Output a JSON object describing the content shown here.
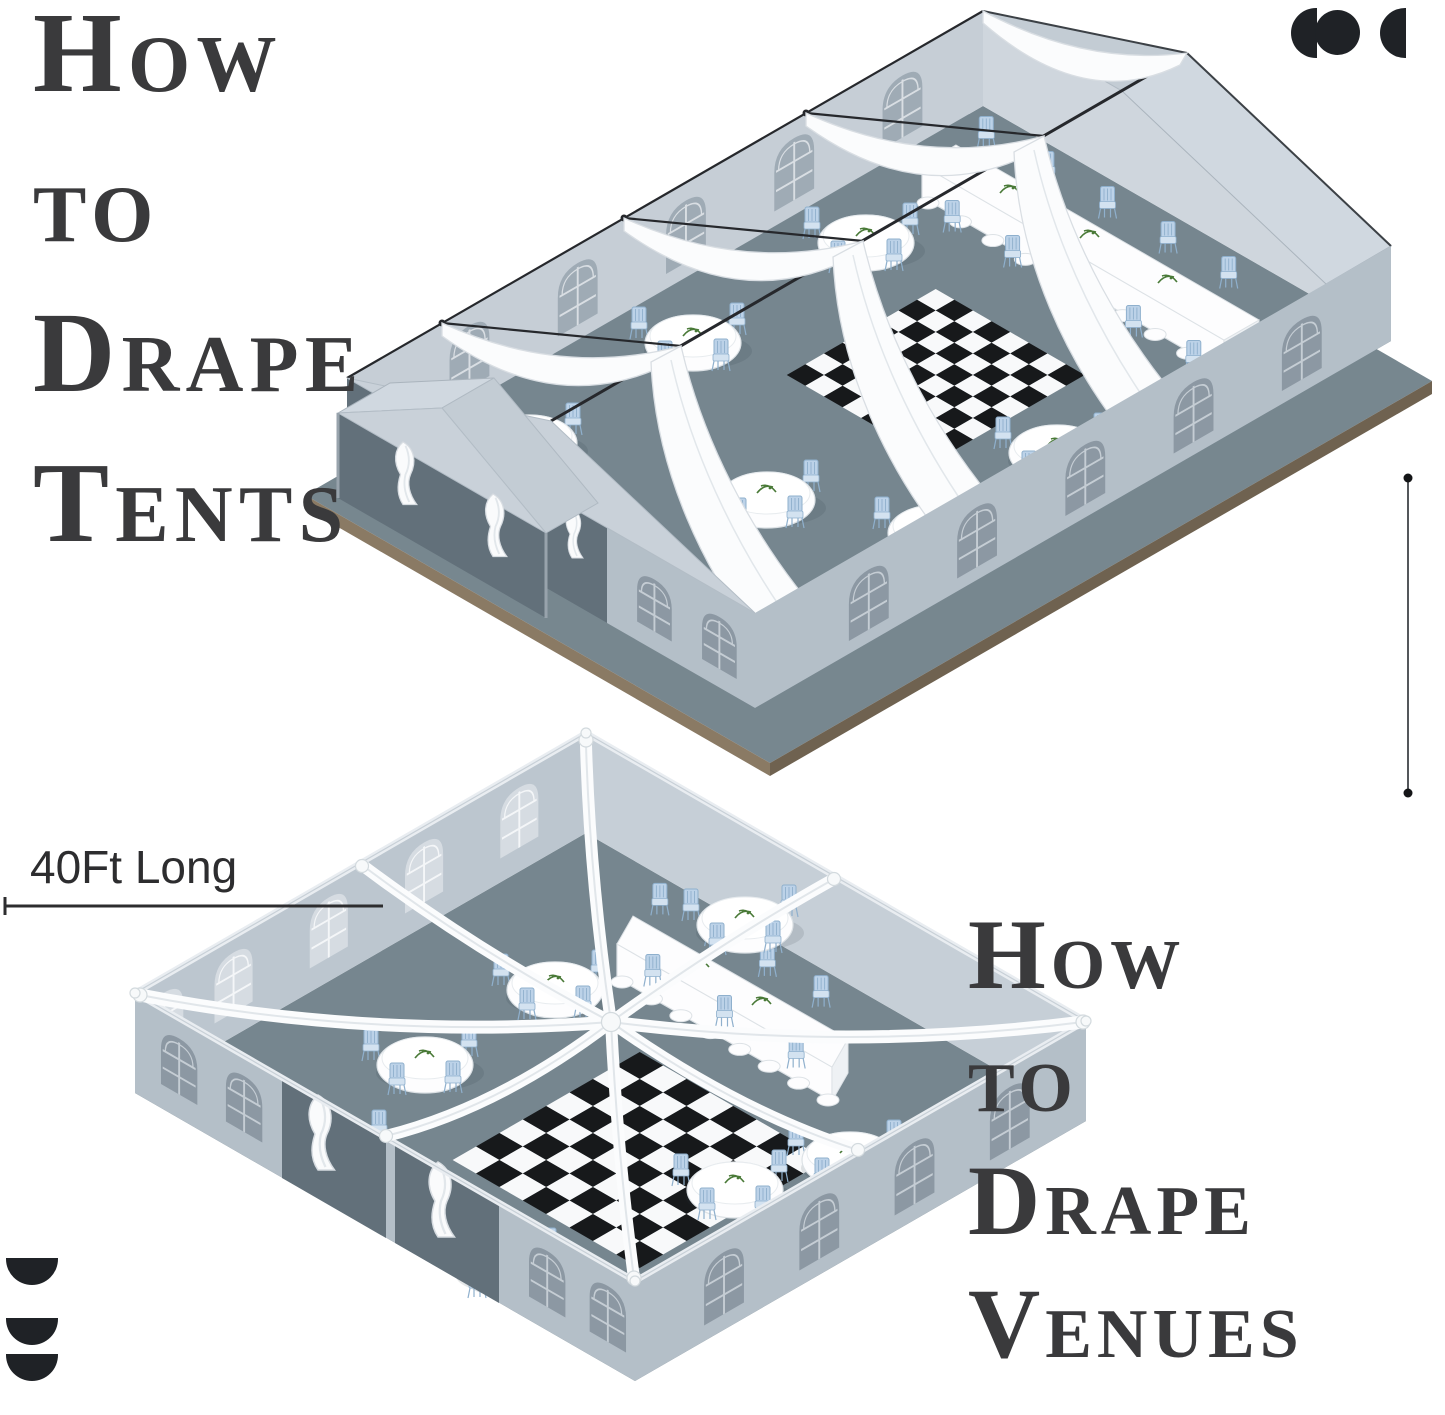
{
  "page": {
    "width": 1445,
    "height": 1415,
    "background": "#ffffff"
  },
  "titles": {
    "left": {
      "lines": [
        "How",
        "to",
        "Drape",
        "Tents"
      ]
    },
    "right": {
      "lines": [
        "How",
        "to",
        "Drape",
        "Venues"
      ]
    }
  },
  "dimensions": {
    "length_label": "40Ft Long"
  },
  "logos": {
    "top_right": {
      "icon": "brand-mark-circles-icon",
      "shapes": [
        "half-disc-left",
        "circle",
        "half-disc-left"
      ]
    },
    "bottom_left": {
      "icon": "brand-mark-half-discs-icon",
      "shapes": [
        "half-disc-down",
        "half-disc-down",
        "half-disc-down"
      ]
    }
  },
  "colors": {
    "background": "#ffffff",
    "title": "#3a3a3c",
    "logo": "#1f2226",
    "dimension": "#2d2d2f",
    "platformTop": "#77878f",
    "platformSideL": "#8a7a64",
    "platformSideR": "#6f6250",
    "floor": "#76868f",
    "wallLight": "#c6ced6",
    "wallGable": "#cfd6dd",
    "wallNear": "#b4bfc8",
    "wallDark": "#62707a",
    "wallInnerL": "#bcc6cf",
    "wallInnerR": "#c6cfd7",
    "roof": "#d0d8e0",
    "gableTri": "#c3ccd4",
    "nearGableTri": "#c9d1d9",
    "drape": "#fbfcfd",
    "drapeEdge": "#d9dee3",
    "checkerDark": "#17191b",
    "checkerLight": "#f8f9fa",
    "chair": "#bcd2e8",
    "chairLine": "#8fb0cd",
    "chairSeat": "#d3e2f0",
    "tableWhite": "#fdfdfe",
    "cable": "#26282c",
    "green": "#4a7a38",
    "windowMid": "#9fabb5",
    "windowDark": "#8c98a3",
    "windowLight": "#d6dce2",
    "mullionOnMid": "#d9dee3",
    "mullionOnDark": "#c5cdd4",
    "mullionOnLight": "#f4f6f8"
  },
  "illustrations": {
    "tent": {
      "checker": {
        "group": "checker-tent",
        "u0": 186,
        "v0": 236,
        "n": 8,
        "cell": 21.5,
        "first_dark": false
      },
      "windows": [
        {
          "group": "tent-win-far",
          "ox": 983,
          "oy": 11,
          "dx": -0.866,
          "dy": 0.5,
          "slots": [
            70,
            195,
            320,
            445,
            570
          ],
          "w": 46,
          "h": 64,
          "yoff": 16,
          "style": "mid"
        },
        {
          "group": "tent-win-near",
          "ox": 1391,
          "oy": 246,
          "dx": -0.866,
          "dy": 0.5,
          "slots": [
            80,
            205,
            330,
            455,
            580
          ],
          "w": 46,
          "h": 62,
          "yoff": 20,
          "style": "dark"
        },
        {
          "group": "tent-win-near",
          "ox": 347,
          "oy": 378,
          "dx": 0.866,
          "dy": 0.5,
          "slots": [
            335,
            410
          ],
          "w": 40,
          "h": 54,
          "yoff": 22,
          "style": "dark"
        }
      ],
      "round_tables": {
        "group": "tables-tent",
        "positions": [
          [
            866,
            243
          ],
          [
            693,
            343
          ],
          [
            529,
            443
          ],
          [
            767,
            500
          ],
          [
            1057,
            453
          ],
          [
            936,
            533
          ],
          [
            710,
            623
          ]
        ]
      },
      "chair_rows": [
        {
          "group": "long-back-tent",
          "x1": 956,
          "y1": 145,
          "x2": 1259,
          "y2": 320,
          "n": 5,
          "dy": -20
        },
        {
          "group": "long-front-tent",
          "x1": 922,
          "y1": 195,
          "x2": 1224,
          "y2": 370,
          "n": 5,
          "dy": 14
        }
      ],
      "hems": [
        {
          "group": "hems-tent",
          "x1": 928,
          "y1": 203,
          "x2": 1220,
          "y2": 372,
          "n": 9
        }
      ]
    },
    "venue": {
      "checker": {
        "group": "checker-venue",
        "u0": 250,
        "v0": 188,
        "n": 8,
        "cell": 27,
        "first_dark": true
      },
      "windows": [
        {
          "group": "venue-win-far",
          "ox": 586,
          "oy": 733,
          "dx": -0.866,
          "dy": 0.5,
          "slots": [
            55,
            165,
            275,
            385,
            465
          ],
          "w": 44,
          "h": 62,
          "yoff": 14,
          "style": "light"
        },
        {
          "group": "venue-win-near",
          "ox": 1086,
          "oy": 1021,
          "dx": -0.866,
          "dy": 0.5,
          "slots": [
            65,
            175,
            285,
            395
          ],
          "w": 46,
          "h": 64,
          "yoff": 20,
          "style": "dark"
        },
        {
          "group": "venue-win-near",
          "ox": 135,
          "oy": 993,
          "dx": 0.866,
          "dy": 0.5,
          "slots": [
            30,
            105,
            455,
            525
          ],
          "w": 42,
          "h": 58,
          "yoff": 18,
          "style": "dark"
        }
      ],
      "round_tables": {
        "group": "tables-venue",
        "positions": [
          [
            745,
            925
          ],
          [
            555,
            990
          ],
          [
            425,
            1065
          ],
          [
            335,
            1150
          ],
          [
            735,
            1190
          ],
          [
            850,
            1160
          ],
          [
            505,
            1268
          ]
        ]
      },
      "chair_rows": [
        {
          "group": "long-back-venue",
          "x1": 633,
          "y1": 916,
          "x2": 848,
          "y2": 1039,
          "n": 4,
          "dy": -22
        },
        {
          "group": "long-front-venue",
          "x1": 617,
          "y1": 944,
          "x2": 832,
          "y2": 1067,
          "n": 3,
          "dy": 16
        }
      ],
      "hems": [
        {
          "group": "hems-venue",
          "x1": 622,
          "y1": 982,
          "x2": 828,
          "y2": 1100,
          "n": 7
        }
      ]
    }
  }
}
